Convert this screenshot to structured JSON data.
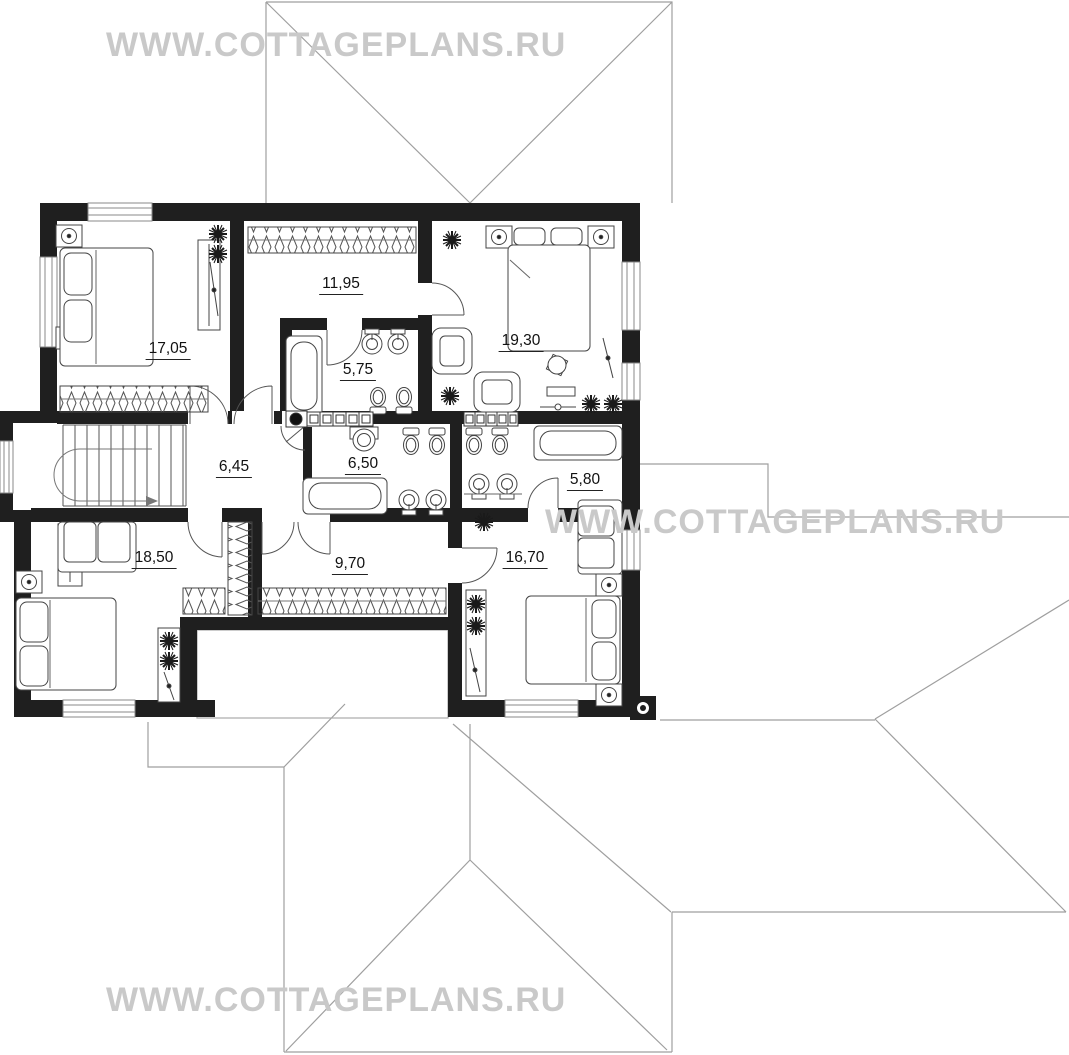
{
  "watermark": {
    "text": "WWW.COTTAGEPLANS.RU",
    "color": "#c9c9c9"
  },
  "rooms": [
    {
      "name": "bedroom-upper-left",
      "area": "17,05"
    },
    {
      "name": "dressing-room-top",
      "area": "11,95"
    },
    {
      "name": "bathroom-top",
      "area": "5,75"
    },
    {
      "name": "bedroom-upper-right",
      "area": "19,30"
    },
    {
      "name": "hall-stairs",
      "area": "6,45"
    },
    {
      "name": "bathroom-middle",
      "area": "6,50"
    },
    {
      "name": "bathroom-right",
      "area": "5,80"
    },
    {
      "name": "bedroom-lower-left",
      "area": "18,50"
    },
    {
      "name": "wardrobe-corridor",
      "area": "9,70"
    },
    {
      "name": "bedroom-lower-right",
      "area": "16,70"
    }
  ],
  "colors": {
    "wall": "#1f1f1f",
    "roof_line": "#9f9f9f",
    "furniture_line": "#444444",
    "watermark": "#c9c9c9",
    "label": "#111111",
    "background": "#ffffff"
  }
}
